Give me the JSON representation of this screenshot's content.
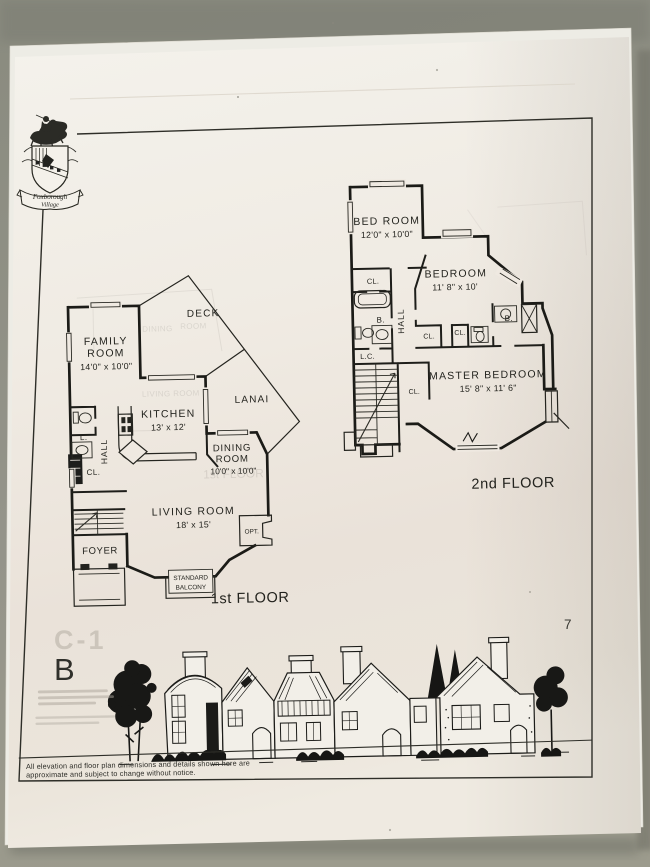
{
  "photo": {
    "page_number": "7",
    "unit_letter": "B",
    "ghost_code": "C-1",
    "crest": {
      "line1": "Foxborough",
      "line2": "Village"
    },
    "disclaimer_line1": "All elevation and floor plan dimensions and details shown here are",
    "disclaimer_line2": "approximate and subject to change without notice."
  },
  "first_floor": {
    "title": "1st FLOOR",
    "family_room_line1": "FAMILY",
    "family_room_line2": "ROOM",
    "family_room_dims": "14'0\" x 10'0\"",
    "deck": "DECK",
    "lanai": "LANAI",
    "kitchen": "KITCHEN",
    "kitchen_dims": "13' x 12'",
    "dining_line1": "DINING",
    "dining_line2": "ROOM",
    "dining_dims": "10'0\" x 10'0\"",
    "living": "LIVING ROOM",
    "living_dims": "18' x 15'",
    "foyer": "FOYER",
    "hall": "HALL",
    "lavatory": "L.",
    "closet": "CL.",
    "optional": "OPT.",
    "balcony_line1": "STANDARD",
    "balcony_line2": "BALCONY"
  },
  "second_floor": {
    "title": "2nd FLOOR",
    "bed_room": "BED ROOM",
    "bed_room_dims": "12'0\" x 10'0\"",
    "bedroom": "BEDROOM",
    "bedroom_dims": "11' 8\" x 10'",
    "master": "MASTER BEDROOM",
    "master_dims": "15' 8\" x 11' 6\"",
    "hall": "HALL",
    "linen_closet": "L.C.",
    "bath_left": "B.",
    "bath_right": "B.",
    "closet_bedroom": "CL.",
    "closet_hall_left": "CL.",
    "closet_hall_right": "CL.",
    "closet_master": "CL."
  }
}
